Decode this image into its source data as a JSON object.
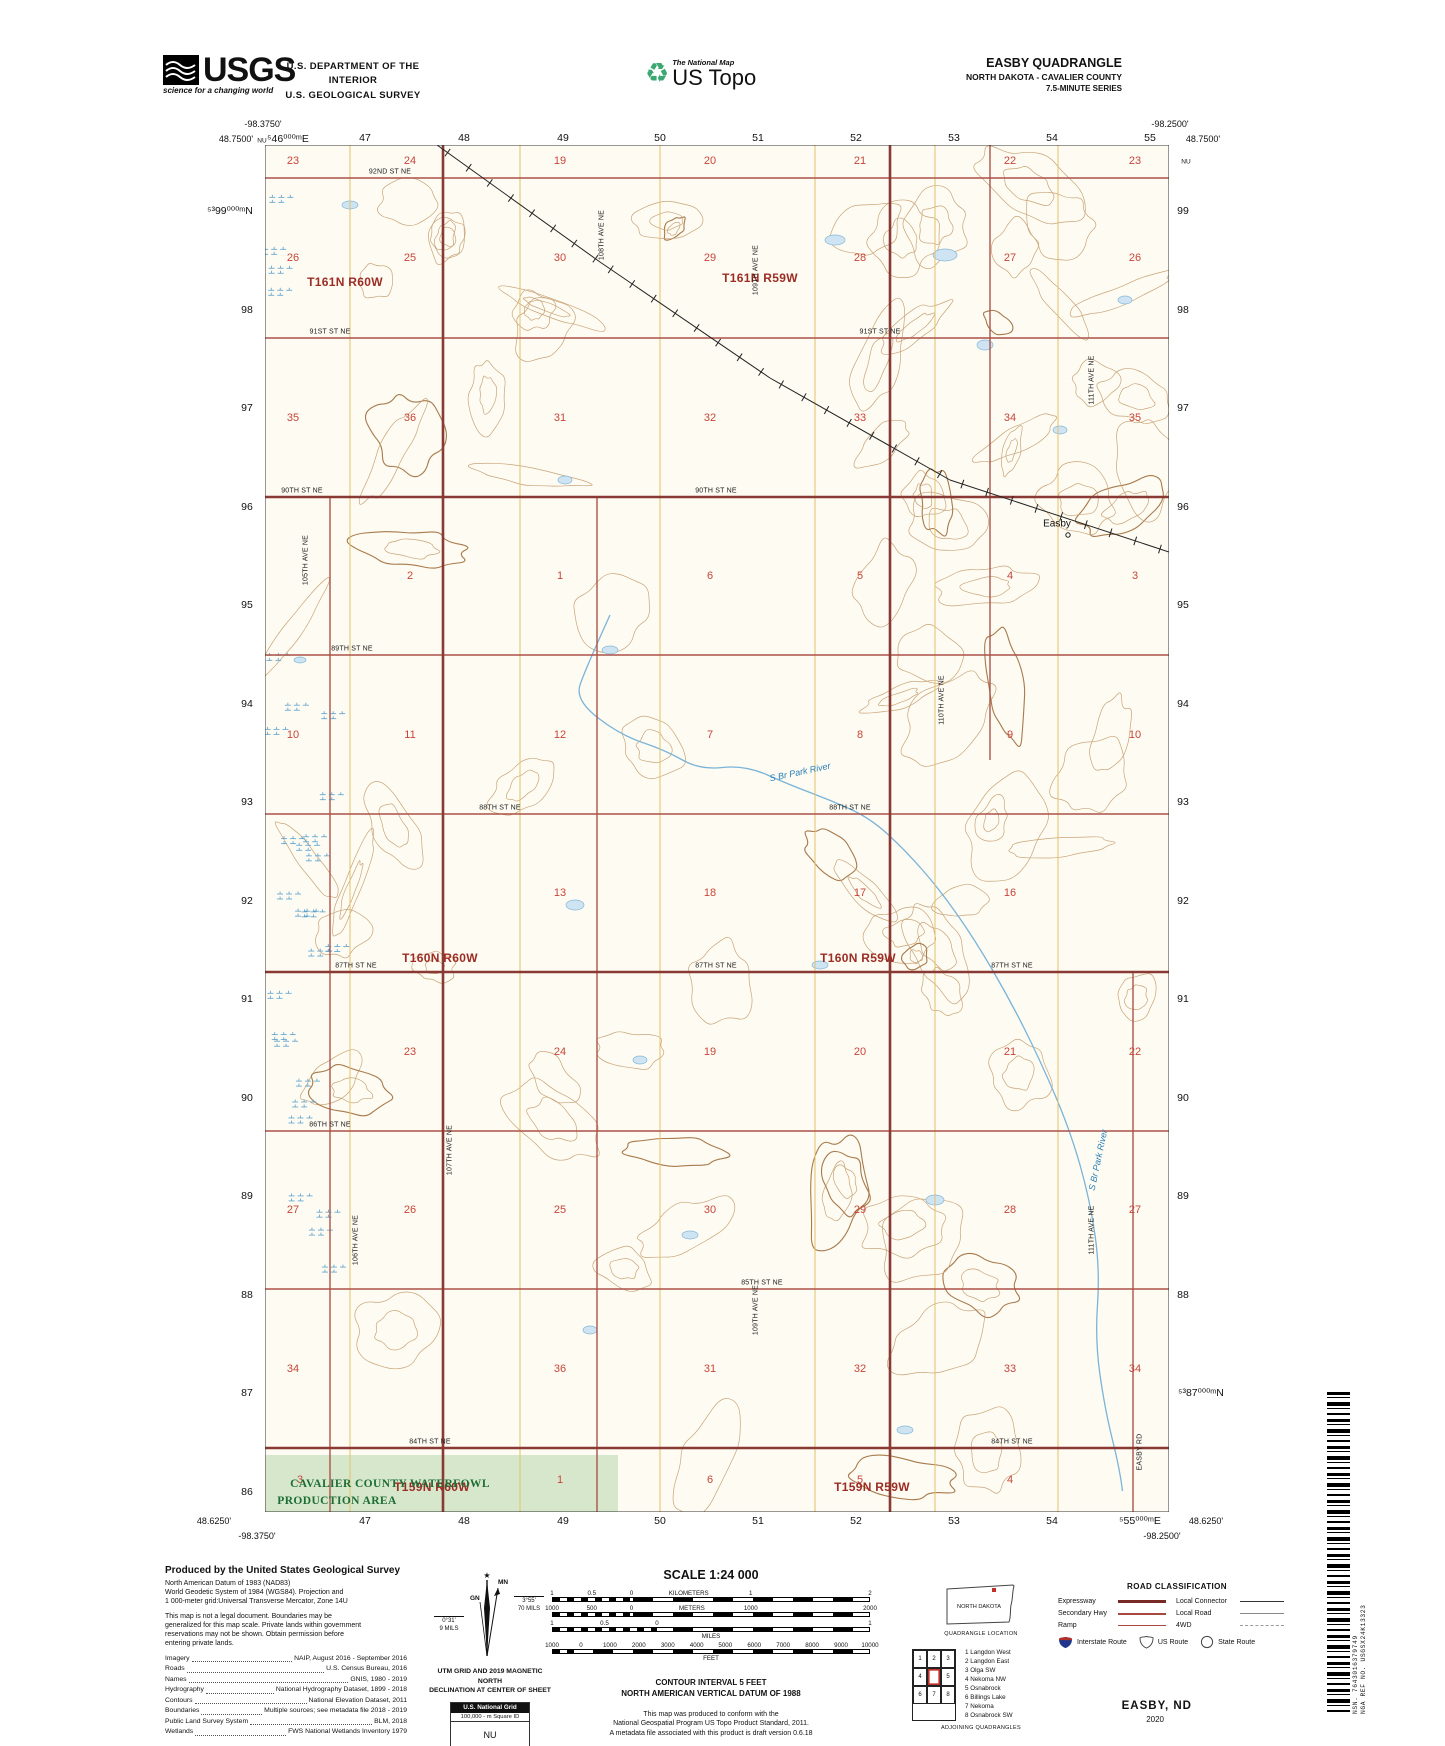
{
  "header": {
    "usgs": {
      "name": "USGS",
      "tagline": "science for a changing world"
    },
    "dept_line1": "U.S. DEPARTMENT OF THE INTERIOR",
    "dept_line2": "U.S. GEOLOGICAL SURVEY",
    "ustopo": {
      "small": "The National Map",
      "large": "US Topo"
    },
    "quad": {
      "title": "EASBY QUADRANGLE",
      "subtitle": "NORTH DAKOTA - CAVALIER COUNTY",
      "series": "7.5-MINUTE SERIES"
    }
  },
  "map": {
    "bg_color": "#fdfbf2",
    "contour_color": "#c9a478",
    "index_contour_color": "#a87a4c",
    "grid_color": "#e3c06a",
    "road_color": "#ab5349",
    "township_line_color": "#8a3a34",
    "water_color": "#7ab4d8",
    "wpa_fill": "#d7e7cc",
    "labels": [
      [
        "-98.3750'",
        263,
        124,
        "coord"
      ],
      [
        "48.7500'",
        236,
        139,
        "coord"
      ],
      [
        "NU",
        262,
        141,
        "coordsm"
      ],
      [
        "⁵46⁰⁰⁰ᵐE",
        288,
        139,
        "utm"
      ],
      [
        "-98.2500'",
        1170,
        124,
        "coord"
      ],
      [
        "48.7500'",
        1203,
        139,
        "coord"
      ],
      [
        "NU",
        1186,
        162,
        "coordsm"
      ],
      [
        "48.6250'",
        214,
        1521,
        "coord"
      ],
      [
        "-98.3750'",
        257,
        1536,
        "coord"
      ],
      [
        "48.6250'",
        1206,
        1521,
        "coord"
      ],
      [
        "-98.2500'",
        1162,
        1536,
        "coord"
      ],
      [
        "47",
        365,
        138,
        "utm"
      ],
      [
        "48",
        464,
        138,
        "utm"
      ],
      [
        "49",
        563,
        138,
        "utm"
      ],
      [
        "50",
        660,
        138,
        "utm"
      ],
      [
        "51",
        758,
        138,
        "utm"
      ],
      [
        "52",
        856,
        138,
        "utm"
      ],
      [
        "53",
        954,
        138,
        "utm"
      ],
      [
        "54",
        1052,
        138,
        "utm"
      ],
      [
        "55",
        1150,
        138,
        "utm"
      ],
      [
        "47",
        365,
        1521,
        "utm"
      ],
      [
        "48",
        464,
        1521,
        "utm"
      ],
      [
        "49",
        563,
        1521,
        "utm"
      ],
      [
        "50",
        660,
        1521,
        "utm"
      ],
      [
        "51",
        758,
        1521,
        "utm"
      ],
      [
        "52",
        856,
        1521,
        "utm"
      ],
      [
        "53",
        954,
        1521,
        "utm"
      ],
      [
        "54",
        1052,
        1521,
        "utm"
      ],
      [
        "⁵55⁰⁰⁰ᵐE",
        1140,
        1521,
        "utm"
      ],
      [
        "⁵³99⁰⁰⁰ᵐN",
        230,
        211,
        "utm"
      ],
      [
        "98",
        247,
        310,
        "utm"
      ],
      [
        "97",
        247,
        408,
        "utm"
      ],
      [
        "96",
        247,
        507,
        "utm"
      ],
      [
        "95",
        247,
        605,
        "utm"
      ],
      [
        "94",
        247,
        704,
        "utm"
      ],
      [
        "93",
        247,
        802,
        "utm"
      ],
      [
        "92",
        247,
        901,
        "utm"
      ],
      [
        "91",
        247,
        999,
        "utm"
      ],
      [
        "90",
        247,
        1098,
        "utm"
      ],
      [
        "89",
        247,
        1196,
        "utm"
      ],
      [
        "88",
        247,
        1295,
        "utm"
      ],
      [
        "87",
        247,
        1393,
        "utm"
      ],
      [
        "86",
        247,
        1492,
        "utm"
      ],
      [
        "99",
        1183,
        211,
        "utm"
      ],
      [
        "98",
        1183,
        310,
        "utm"
      ],
      [
        "97",
        1183,
        408,
        "utm"
      ],
      [
        "96",
        1183,
        507,
        "utm"
      ],
      [
        "95",
        1183,
        605,
        "utm"
      ],
      [
        "94",
        1183,
        704,
        "utm"
      ],
      [
        "93",
        1183,
        802,
        "utm"
      ],
      [
        "92",
        1183,
        901,
        "utm"
      ],
      [
        "91",
        1183,
        999,
        "utm"
      ],
      [
        "90",
        1183,
        1098,
        "utm"
      ],
      [
        "89",
        1183,
        1196,
        "utm"
      ],
      [
        "88",
        1183,
        1295,
        "utm"
      ],
      [
        "⁵³87⁰⁰⁰ᵐN",
        1201,
        1393,
        "utm"
      ],
      [
        "T161N R60W",
        345,
        282,
        "twp"
      ],
      [
        "T161N R59W",
        760,
        278,
        "twp"
      ],
      [
        "T160N R60W",
        440,
        958,
        "twp"
      ],
      [
        "T160N R59W",
        858,
        958,
        "twp"
      ],
      [
        "T159N R60W",
        432,
        1487,
        "twp"
      ],
      [
        "T159N R59W",
        872,
        1487,
        "twp"
      ],
      [
        "92ND ST NE",
        390,
        172,
        "road"
      ],
      [
        "91ST ST NE",
        330,
        332,
        "road"
      ],
      [
        "91ST ST NE",
        880,
        332,
        "road"
      ],
      [
        "90TH ST NE",
        302,
        491,
        "road"
      ],
      [
        "90TH ST NE",
        716,
        491,
        "road"
      ],
      [
        "89TH ST NE",
        352,
        649,
        "road"
      ],
      [
        "88TH ST NE",
        500,
        808,
        "road"
      ],
      [
        "88TH ST NE",
        850,
        808,
        "road"
      ],
      [
        "87TH ST NE",
        356,
        966,
        "road"
      ],
      [
        "87TH ST NE",
        716,
        966,
        "road"
      ],
      [
        "87TH ST NE",
        1012,
        966,
        "road"
      ],
      [
        "86TH ST NE",
        330,
        1125,
        "road"
      ],
      [
        "85TH ST NE",
        762,
        1283,
        "road"
      ],
      [
        "84TH ST NE",
        430,
        1442,
        "road"
      ],
      [
        "84TH ST NE",
        1012,
        1442,
        "road"
      ],
      [
        "105TH AVE NE",
        306,
        560,
        "roadv"
      ],
      [
        "106TH AVE NE",
        356,
        1240,
        "roadv"
      ],
      [
        "107TH AVE NE",
        450,
        1150,
        "roadv"
      ],
      [
        "108TH AVE NE",
        602,
        235,
        "roadv"
      ],
      [
        "109TH AVE NE",
        756,
        270,
        "roadv"
      ],
      [
        "109TH AVE NE",
        756,
        1310,
        "roadv"
      ],
      [
        "110TH AVE NE",
        942,
        700,
        "roadv"
      ],
      [
        "111TH AVE NE",
        1092,
        380,
        "roadv"
      ],
      [
        "111TH AVE NE",
        1092,
        1230,
        "roadv"
      ],
      [
        "EASBY RD",
        1140,
        1452,
        "roadv"
      ],
      [
        "23",
        293,
        161,
        "sec"
      ],
      [
        "24",
        410,
        161,
        "sec"
      ],
      [
        "19",
        560,
        161,
        "sec"
      ],
      [
        "20",
        710,
        161,
        "sec"
      ],
      [
        "21",
        860,
        161,
        "sec"
      ],
      [
        "22",
        1010,
        161,
        "sec"
      ],
      [
        "23",
        1135,
        161,
        "sec"
      ],
      [
        "26",
        293,
        258,
        "sec"
      ],
      [
        "25",
        410,
        258,
        "sec"
      ],
      [
        "30",
        560,
        258,
        "sec"
      ],
      [
        "29",
        710,
        258,
        "sec"
      ],
      [
        "28",
        860,
        258,
        "sec"
      ],
      [
        "27",
        1010,
        258,
        "sec"
      ],
      [
        "26",
        1135,
        258,
        "sec"
      ],
      [
        "35",
        293,
        418,
        "sec"
      ],
      [
        "36",
        410,
        418,
        "sec"
      ],
      [
        "31",
        560,
        418,
        "sec"
      ],
      [
        "32",
        710,
        418,
        "sec"
      ],
      [
        "33",
        860,
        418,
        "sec"
      ],
      [
        "34",
        1010,
        418,
        "sec"
      ],
      [
        "35",
        1135,
        418,
        "sec"
      ],
      [
        "2",
        410,
        576,
        "sec"
      ],
      [
        "1",
        560,
        576,
        "sec"
      ],
      [
        "6",
        710,
        576,
        "sec"
      ],
      [
        "5",
        860,
        576,
        "sec"
      ],
      [
        "4",
        1010,
        576,
        "sec"
      ],
      [
        "3",
        1135,
        576,
        "sec"
      ],
      [
        "10",
        293,
        735,
        "sec"
      ],
      [
        "11",
        410,
        735,
        "sec"
      ],
      [
        "12",
        560,
        735,
        "sec"
      ],
      [
        "7",
        710,
        735,
        "sec"
      ],
      [
        "8",
        860,
        735,
        "sec"
      ],
      [
        "9",
        1010,
        735,
        "sec"
      ],
      [
        "10",
        1135,
        735,
        "sec"
      ],
      [
        "13",
        560,
        893,
        "sec"
      ],
      [
        "18",
        710,
        893,
        "sec"
      ],
      [
        "17",
        860,
        893,
        "sec"
      ],
      [
        "16",
        1010,
        893,
        "sec"
      ],
      [
        "23",
        410,
        1052,
        "sec"
      ],
      [
        "24",
        560,
        1052,
        "sec"
      ],
      [
        "19",
        710,
        1052,
        "sec"
      ],
      [
        "20",
        860,
        1052,
        "sec"
      ],
      [
        "21",
        1010,
        1052,
        "sec"
      ],
      [
        "22",
        1135,
        1052,
        "sec"
      ],
      [
        "27",
        293,
        1210,
        "sec"
      ],
      [
        "26",
        410,
        1210,
        "sec"
      ],
      [
        "25",
        560,
        1210,
        "sec"
      ],
      [
        "30",
        710,
        1210,
        "sec"
      ],
      [
        "29",
        860,
        1210,
        "sec"
      ],
      [
        "28",
        1010,
        1210,
        "sec"
      ],
      [
        "27",
        1135,
        1210,
        "sec"
      ],
      [
        "34",
        293,
        1369,
        "sec"
      ],
      [
        "36",
        560,
        1369,
        "sec"
      ],
      [
        "31",
        710,
        1369,
        "sec"
      ],
      [
        "32",
        860,
        1369,
        "sec"
      ],
      [
        "33",
        1010,
        1369,
        "sec"
      ],
      [
        "34",
        1135,
        1369,
        "sec"
      ],
      [
        "3",
        300,
        1480,
        "sec"
      ],
      [
        "1",
        560,
        1480,
        "sec"
      ],
      [
        "6",
        710,
        1480,
        "sec"
      ],
      [
        "5",
        860,
        1480,
        "sec"
      ],
      [
        "4",
        1010,
        1480,
        "sec"
      ],
      [
        "S Br Park River",
        800,
        772,
        "water rotA"
      ],
      [
        "S Br Park River",
        1098,
        1160,
        "water rotB"
      ],
      [
        "Easby",
        1057,
        524,
        "town"
      ],
      [
        "CAVALIER COUNTY WATERFOWL",
        390,
        1484,
        "wpa"
      ],
      [
        "PRODUCTION AREA",
        337,
        1501,
        "wpa"
      ]
    ]
  },
  "produced": {
    "title": "Produced by the United States Geological Survey",
    "datum_par": "North American Datum of 1983 (NAD83)\nWorld Geodetic System of 1984 (WGS84).  Projection and\n1 000-meter grid:Universal Transverse Mercator, Zone 14U",
    "legal_par": "This map is not a legal document. Boundaries may be\ngeneralized for this map scale. Private lands within government\nreservations may not be shown. Obtain permission before\nentering private lands."
  },
  "credits": [
    [
      "Imagery",
      "NAIP, August 2016 - September 2016"
    ],
    [
      "Roads",
      "U.S. Census Bureau, 2016"
    ],
    [
      "Names",
      "GNIS, 1980 - 2019"
    ],
    [
      "Hydrography",
      "National Hydrography Dataset, 1899 - 2018"
    ],
    [
      "Contours",
      "National Elevation Dataset, 2011"
    ],
    [
      "Boundaries",
      "Multiple sources; see metadata file 2018 - 2019"
    ],
    [
      "Public Land Survey System",
      "BLM, 2018"
    ],
    [
      "Wetlands",
      "FWS National Wetlands Inventory 1979"
    ]
  ],
  "declination": {
    "star": "★",
    "mn": "MN",
    "gn": "GN",
    "right1": "3°55'",
    "right2": "70 MILS",
    "left1": "0°31'",
    "left2": "9 MILS",
    "caption": "UTM GRID AND 2019 MAGNETIC NORTH\nDECLINATION AT CENTER OF SHEET"
  },
  "usng": {
    "title": "U.S. National Grid",
    "sub": "100,000 - m Square ID",
    "square_id": "NU",
    "gz_label": "Grid Zone Designation",
    "zone": "14U"
  },
  "scale": {
    "title": "SCALE 1:24 000",
    "bars": [
      {
        "fine": 25,
        "labels": [
          [
            "1",
            0
          ],
          [
            "0.5",
            12.5
          ],
          [
            "0",
            25
          ],
          [
            "KILOMETERS",
            43
          ],
          [
            "1",
            62.5
          ],
          [
            "2",
            100
          ]
        ]
      },
      {
        "fine": 25,
        "labels": [
          [
            "1000",
            0
          ],
          [
            "500",
            12.5
          ],
          [
            "0",
            25
          ],
          [
            "METERS",
            44
          ],
          [
            "1000",
            62.5
          ],
          [
            "2000",
            100
          ]
        ]
      },
      {
        "fine": 33,
        "labels": [
          [
            "1",
            0
          ],
          [
            "0.5",
            16.5
          ],
          [
            "0",
            33
          ],
          [
            "1",
            100
          ]
        ],
        "word_below": "MILES"
      },
      {
        "fine": 9,
        "labels": [
          [
            "1000",
            0
          ],
          [
            "0",
            9.1
          ],
          [
            "1000",
            18.2
          ],
          [
            "2000",
            27.3
          ],
          [
            "3000",
            36.4
          ],
          [
            "4000",
            45.5
          ],
          [
            "5000",
            54.5
          ],
          [
            "6000",
            63.6
          ],
          [
            "7000",
            72.7
          ],
          [
            "8000",
            81.8
          ],
          [
            "9000",
            90.9
          ],
          [
            "10000",
            100
          ]
        ],
        "word_below": "FEET"
      }
    ],
    "contour": "CONTOUR INTERVAL 5 FEET",
    "datum": "NORTH AMERICAN VERTICAL DATUM OF 1988",
    "conform": "This map was produced to conform with the\nNational Geospatial Program US Topo Product Standard, 2011.\nA metadata file associated with this product is draft version 0.6.18"
  },
  "location": {
    "state_name": "NORTH DAKOTA",
    "caption": "QUADRANGLE LOCATION",
    "adjoining_caption": "ADJOINING QUADRANGLES",
    "grid_numbers": [
      "1",
      "2",
      "3",
      "4",
      "5",
      "6",
      "7",
      "8"
    ],
    "names": [
      "1 Langdon West",
      "2 Langdon East",
      "3 Olga SW",
      "4 Nekoma NW",
      "5 Osnabrock",
      "6 Billings Lake",
      "7 Nekoma",
      "8 Osnabrock SW"
    ]
  },
  "road_class": {
    "title": "ROAD CLASSIFICATION",
    "left": [
      {
        "label": "Expressway",
        "cls": "expwy"
      },
      {
        "label": "Secondary Hwy",
        "cls": "schwy"
      },
      {
        "label": "Ramp",
        "cls": "ramp"
      }
    ],
    "right": [
      {
        "label": "Local Connector",
        "cls": "loccon"
      },
      {
        "label": "Local Road",
        "cls": "locroad"
      },
      {
        "label": "4WD",
        "cls": "fwd"
      }
    ],
    "interstate_label": "Interstate Route",
    "us_label": "US Route",
    "state_label": "State Route"
  },
  "pub": {
    "name": "EASBY,  ND",
    "year": "2020"
  },
  "barcode": {
    "nsn": "NSN.  7643016379749",
    "nga": "NGA REF NO.  USGSX24K13323"
  }
}
